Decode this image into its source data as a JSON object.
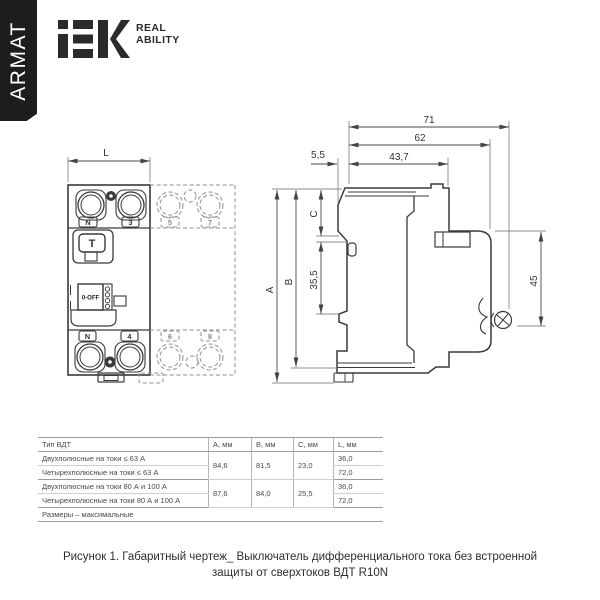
{
  "header": {
    "armat": "ARMAT",
    "brand": "iEK",
    "tagline_line1": "REAL",
    "tagline_line2": "ABILITY"
  },
  "front_view": {
    "dim_l": "L",
    "terminal_n_top": "N",
    "terminal_3": "3",
    "terminal_5": "5",
    "terminal_7": "7",
    "terminal_n_bottom": "N",
    "terminal_4": "4",
    "terminal_6": "6",
    "terminal_8": "8",
    "test_button": "T",
    "toggle": "0-OFF"
  },
  "side_view": {
    "dim_71": "71",
    "dim_62": "62",
    "dim_5_5": "5,5",
    "dim_43_7": "43,7",
    "dim_a": "A",
    "dim_b": "B",
    "dim_c": "C",
    "dim_35_5": "35,5",
    "dim_45": "45"
  },
  "table": {
    "headers": [
      "Тип ВДТ",
      "A, мм",
      "B, мм",
      "C, мм",
      "L, мм"
    ],
    "rows": [
      [
        "Двухполюсные на токи ≤ 63 А",
        "84,6",
        "81,5",
        "23,0",
        "36,0"
      ],
      [
        "Четырехполюсные на токи ≤ 63 А",
        "72,0"
      ],
      [
        "Двухполюсные на токи 80 А и 100 А",
        "87,6",
        "84,0",
        "25,5",
        "36,0"
      ],
      [
        "Четырехполюсные на токи 80 А и 100 А",
        "72,0"
      ]
    ],
    "note": "Размеры – максимальные"
  },
  "caption": {
    "line1": "Рисунок 1. Габаритный чертеж_ Выключатель дифференциального тока без встроенной",
    "line2": "защиты от сверхтоков ВДТ R10N"
  },
  "colors": {
    "ink": "#3a3a3a",
    "dashed_gray": "#8f8f8f",
    "banner_black": "#1d1d1d"
  }
}
